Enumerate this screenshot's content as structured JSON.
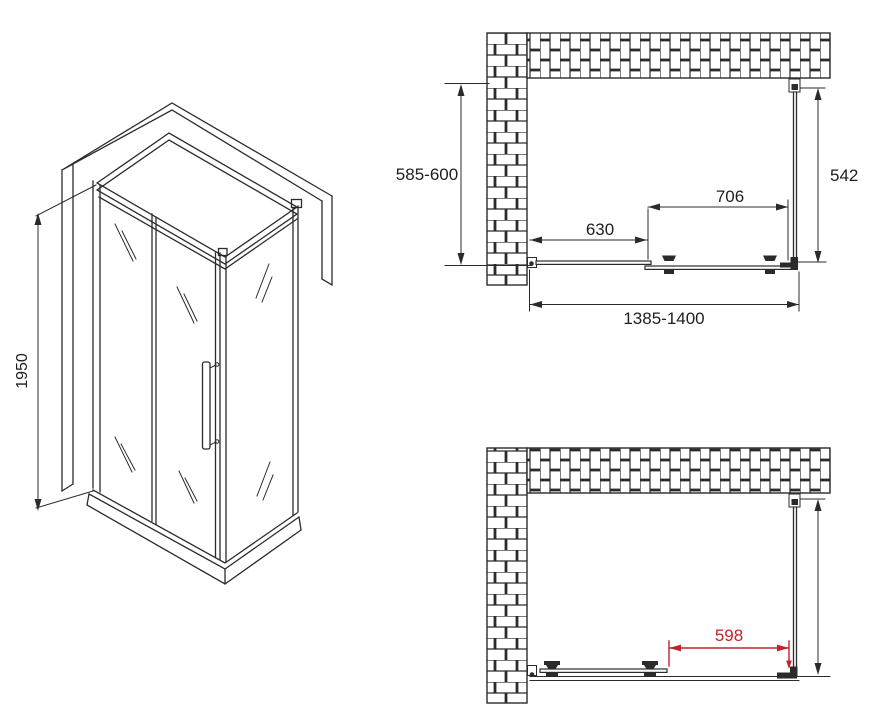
{
  "title": "shower-enclosure-technical-drawing",
  "colors": {
    "line": "#2b2b2b",
    "accent_red": "#c5212b",
    "background": "#ffffff"
  },
  "views": {
    "isometric": {
      "height_label": "1950"
    },
    "plan_closed": {
      "depth_label": "585-600",
      "fixed_panel_label": "630",
      "door_label": "706",
      "side_panel_label": "542",
      "width_label": "1385-1400"
    },
    "plan_open": {
      "opening_label": "598"
    }
  }
}
